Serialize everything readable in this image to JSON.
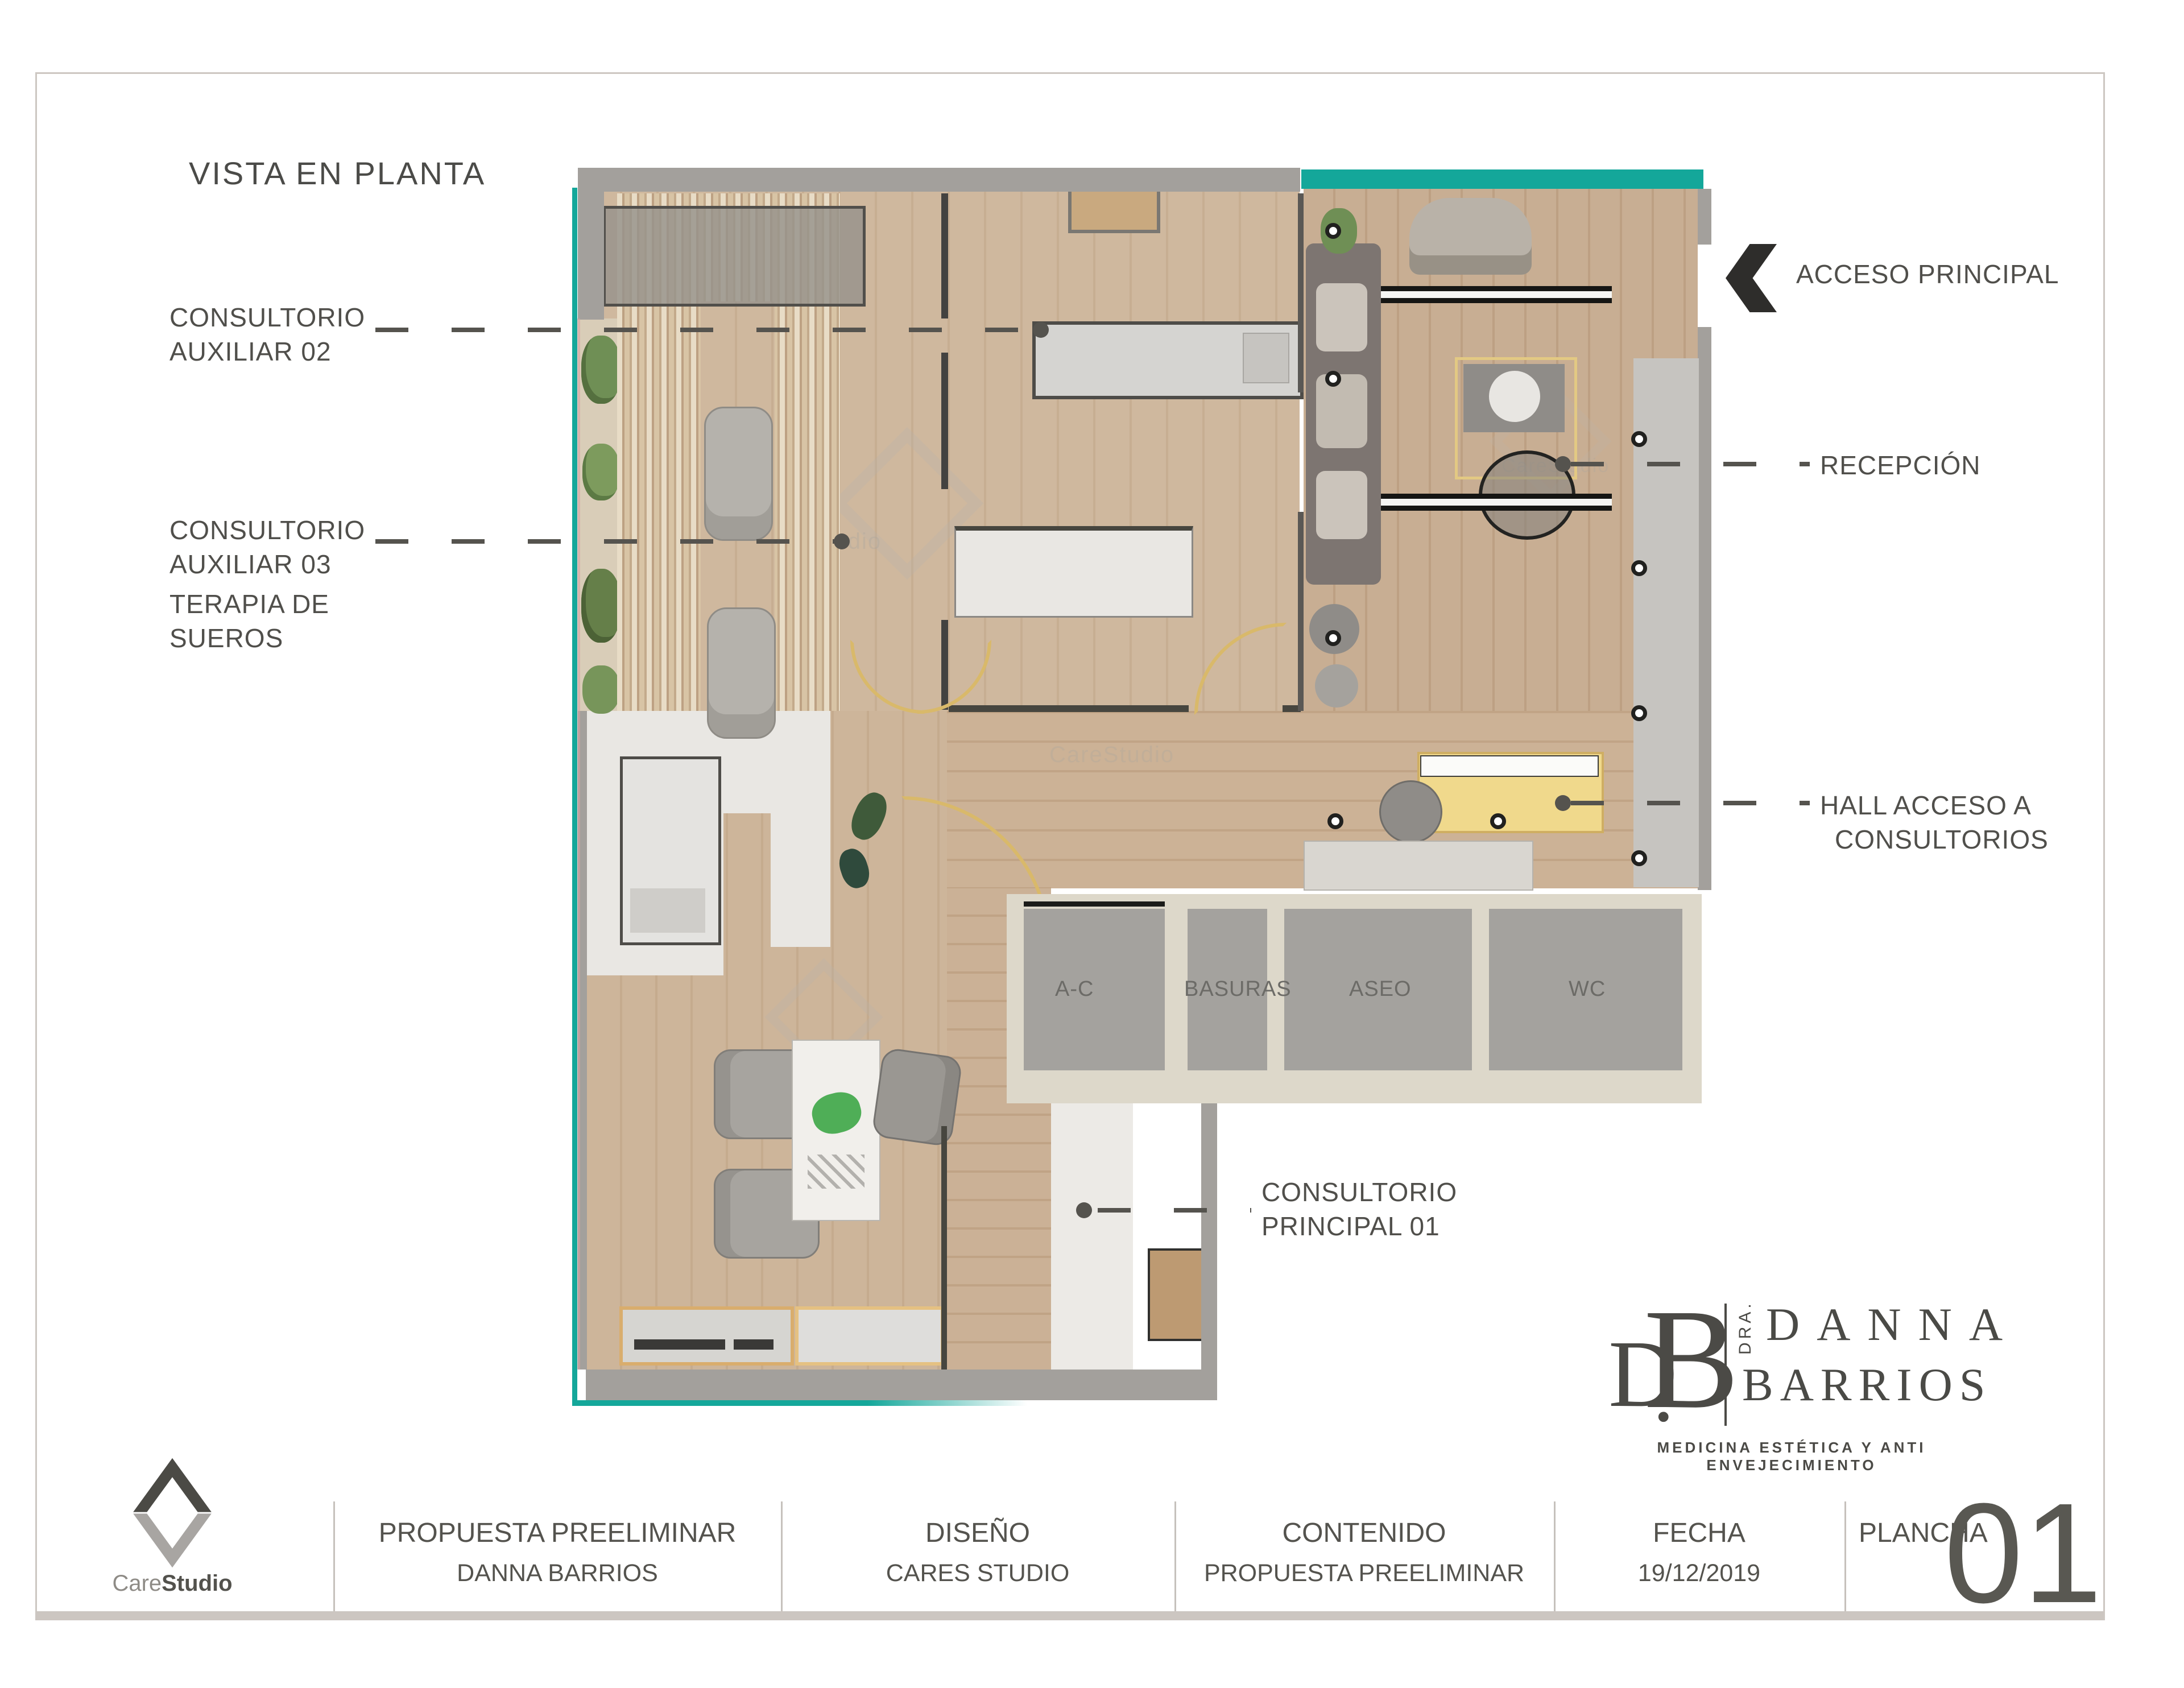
{
  "page": {
    "title": "VISTA EN PLANTA"
  },
  "annotations": {
    "aux02_line1": "CONSULTORIO",
    "aux02_line2": "AUXILIAR 02",
    "aux03_line1": "CONSULTORIO",
    "aux03_line2": "AUXILIAR 03",
    "aux03_line3": "TERAPIA DE",
    "aux03_line4": "SUEROS",
    "acceso": "ACCESO PRINCIPAL",
    "recepcion": "RECEPCIÓN",
    "hall_line1": "HALL ACCESO A",
    "hall_line2": "CONSULTORIOS",
    "principal_line1": "CONSULTORIO",
    "principal_line2": "PRINCIPAL 01"
  },
  "plan": {
    "rooms": {
      "ac": "A-C",
      "basuras": "BASURAS",
      "aseo": "ASEO",
      "wc": "WC"
    },
    "watermark": "CareStudio"
  },
  "brand": {
    "monogram_d": "D",
    "monogram_dot": ".",
    "monogram_b": "B",
    "dra": "DRA.",
    "name_line1": "DANNA",
    "name_line2": "BARRIOS",
    "tagline": "MEDICINA ESTÉTICA Y ANTI ENVEJECIMIENTO"
  },
  "titleblock": {
    "studio_care": "Care",
    "studio_studio": "Studio",
    "cells": [
      {
        "line1": "PROPUESTA PREELIMINAR",
        "line2": "DANNA BARRIOS"
      },
      {
        "line1": "DISEÑO",
        "line2": "CARES STUDIO"
      },
      {
        "line1": "CONTENIDO",
        "line2": "PROPUESTA PREELIMINAR"
      },
      {
        "line1": "FECHA",
        "line2": "19/12/2019"
      },
      {
        "line1": "PLANCHA",
        "line2": "01"
      }
    ]
  },
  "colors": {
    "accent_teal": "#14a79a",
    "leader": "#55534e",
    "text": "#4f4e4a",
    "wood": "#cdb69c",
    "wall": "#a3a09c",
    "utility_floor": "#a4a29e",
    "desk_yellow": "#f0d98c",
    "door_arc": "#d9b96a"
  }
}
